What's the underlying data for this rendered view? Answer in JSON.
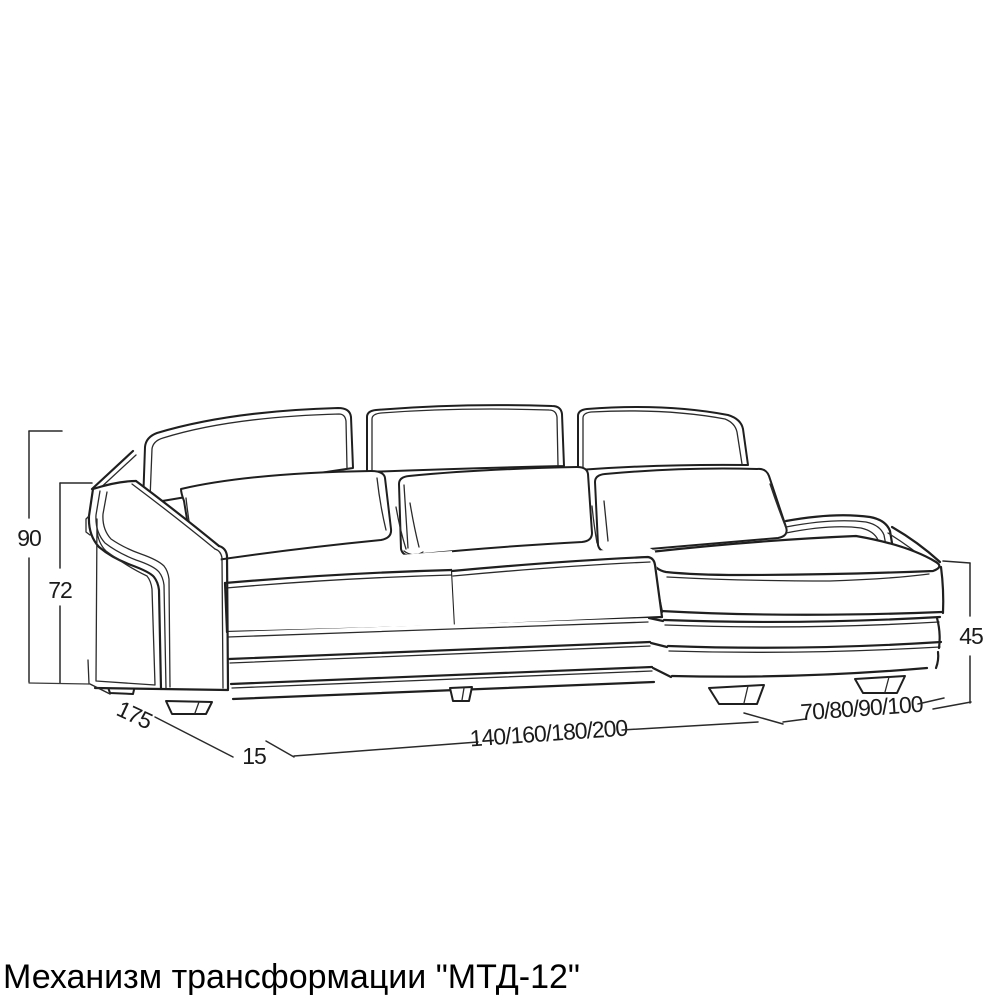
{
  "title": "Механизм трансформации \"МТД-12\"",
  "dimensions": {
    "back_height": "90",
    "seat_height": "72",
    "depth": "175",
    "arm_width": "15",
    "seat_widths": "140/160/180/200",
    "chaise_widths": "70/80/90/100",
    "chaise_height": "45"
  },
  "figure": {
    "type": "technical line drawing",
    "subject": "corner sofa with chaise lounge, three back cushions and three pillows",
    "line_color": "#1f1f1f",
    "background_color": "#ffffff"
  }
}
